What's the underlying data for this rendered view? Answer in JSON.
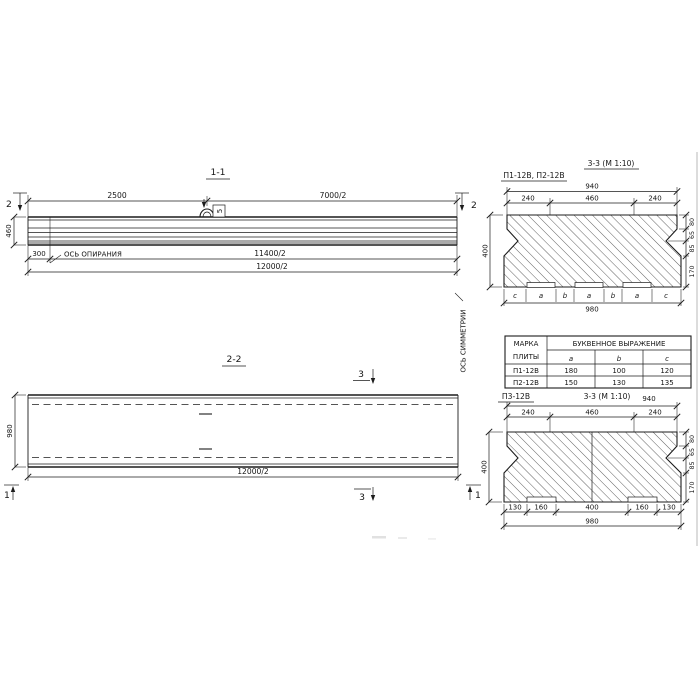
{
  "s11": {
    "title": "1-1",
    "dim_a": "2500",
    "dim_b": "7000/2",
    "height": "460",
    "cut_left": "2",
    "cut_right": "2",
    "dim_300": "300",
    "bearing_axis": "ОСЬ ОПИРАНИЯ",
    "dim_half1": "11400/2",
    "dim_half2": "12000/2",
    "loop_tag": "5"
  },
  "s22": {
    "title": "2-2",
    "width": "980",
    "dim_half": "12000/2",
    "cut3_top": "3",
    "cut3_bottom": "3",
    "cut1_left": "1",
    "cut1_right": "1",
    "symmetry_axis": "ОСЬ СИММЕТРИИ"
  },
  "s33top": {
    "label": "П1-12В, П2-12В",
    "title": "3-3 (М 1:10)",
    "dim_940": "940",
    "dims_top": [
      "240",
      "460",
      "240"
    ],
    "dim_400": "400",
    "dims_right": [
      "80",
      "65",
      "85",
      "170"
    ],
    "letters": [
      "c",
      "a",
      "b",
      "a",
      "b",
      "a",
      "c"
    ],
    "dim_980": "980"
  },
  "table": {
    "h_mark_1": "МАРКА",
    "h_mark_2": "ПЛИТЫ",
    "h_expr": "БУКВЕННОЕ ВЫРАЖЕНИЕ",
    "cols": [
      "a",
      "b",
      "c"
    ],
    "rows": [
      {
        "mark": "П1-12В",
        "a": "180",
        "b": "100",
        "c": "120"
      },
      {
        "mark": "П2-12В",
        "a": "150",
        "b": "130",
        "c": "135"
      }
    ]
  },
  "s33bot": {
    "label": "П3-12В",
    "title": "3-3 (М 1:10)",
    "dim_940": "940",
    "dims_top": [
      "240",
      "460",
      "240"
    ],
    "dim_400": "400",
    "dims_right": [
      "80",
      "65",
      "85",
      "170"
    ],
    "dims_bottom": [
      "130",
      "160",
      "400",
      "160",
      "130"
    ],
    "dim_980": "980"
  }
}
